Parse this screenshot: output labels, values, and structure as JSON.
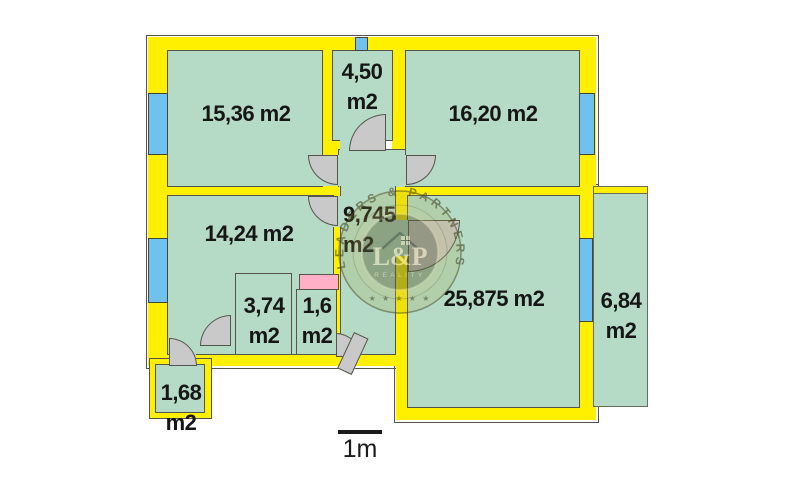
{
  "rooms": [
    {
      "id": "room-15-36",
      "label": "15,36 m2"
    },
    {
      "id": "room-4-50",
      "label": "4,50 m2"
    },
    {
      "id": "room-16-20",
      "label": "16,20 m2"
    },
    {
      "id": "hallway",
      "label": "9,745 m2"
    },
    {
      "id": "room-14-24",
      "label": "14,24 m2"
    },
    {
      "id": "room-3-74",
      "label": "3,74 m2"
    },
    {
      "id": "room-1-6",
      "label": "1,6 m2"
    },
    {
      "id": "room-25-875",
      "label": "25,875 m2"
    },
    {
      "id": "balcony-6-84",
      "label": "6,84 m2"
    },
    {
      "id": "balcony-1-68",
      "label": "1,68 m2"
    }
  ],
  "scale": {
    "label": "1m"
  },
  "watermark": {
    "ring_text": "LEADERS & PARTNERS",
    "monogram": "L&P",
    "subtitle": "REALITY",
    "stars": "★ ★ ★ ★ ★"
  },
  "colors": {
    "wall": "#FFF000",
    "room": "#B5DBC6",
    "window": "#6FC2EE",
    "door": "#C9C9C9",
    "accent_pink": "#FFB0C6"
  }
}
